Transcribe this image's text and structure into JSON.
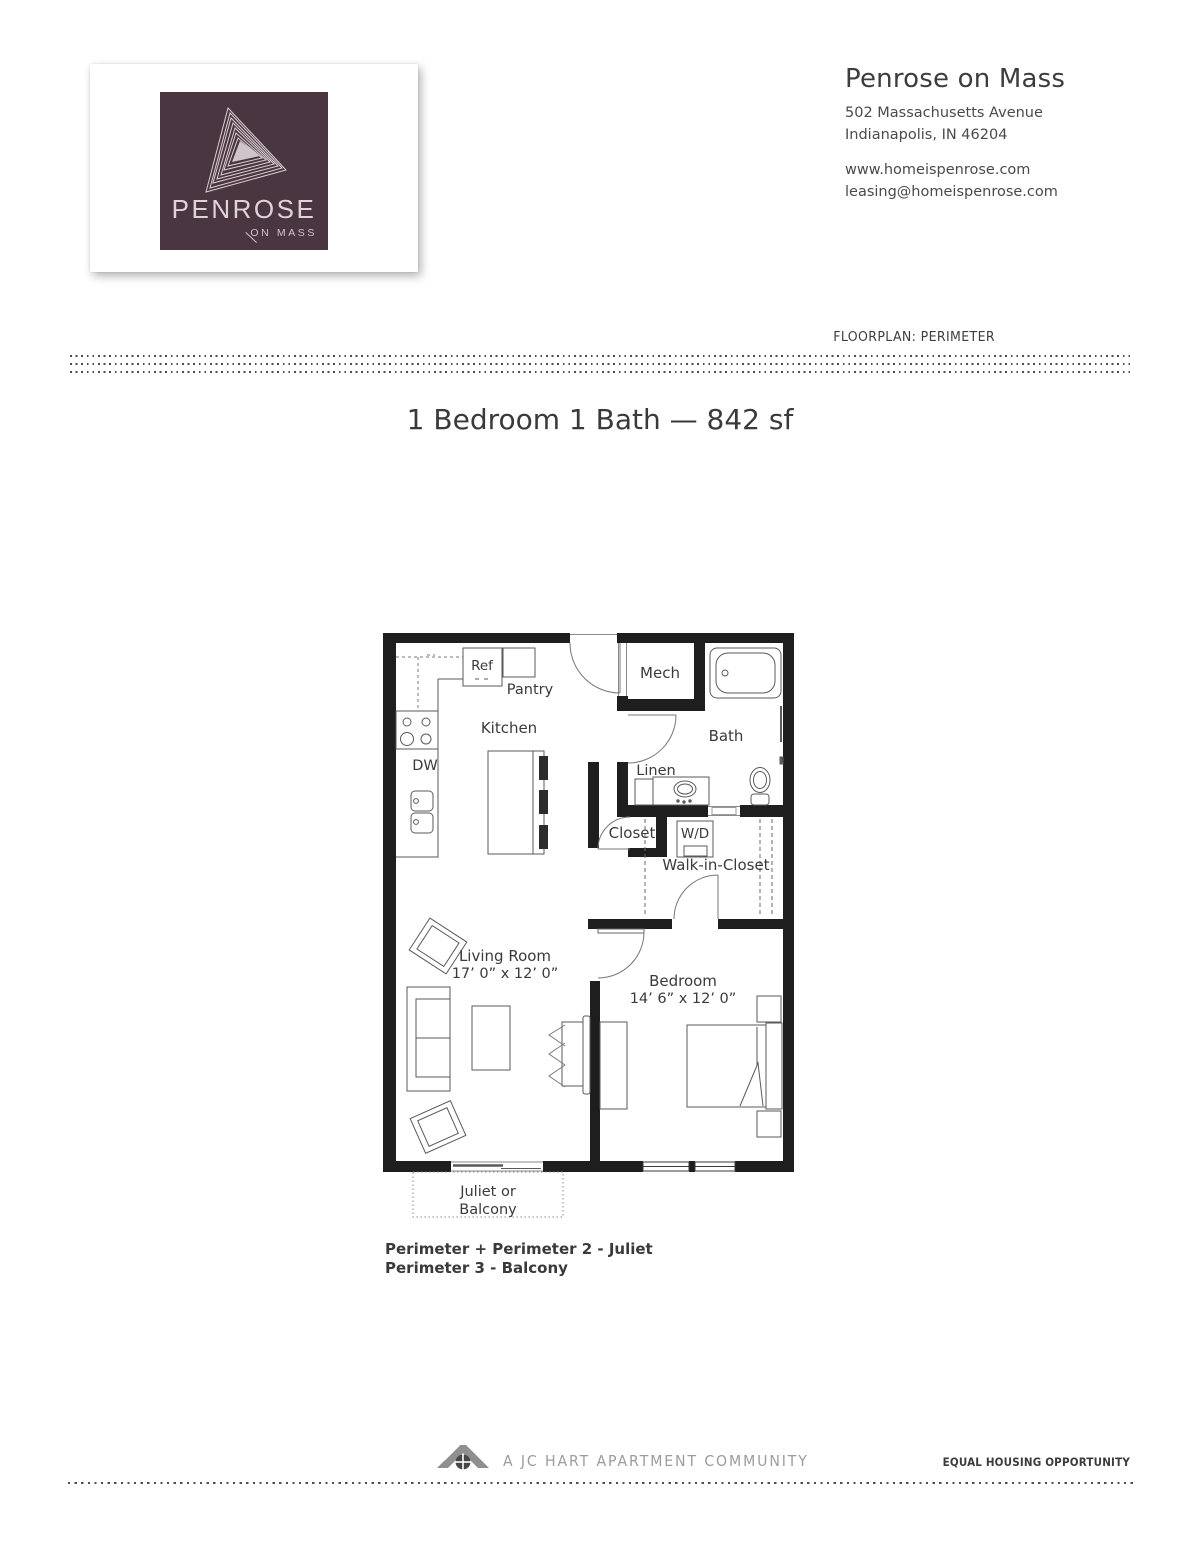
{
  "colors": {
    "logo_bg": "#4a3640",
    "logo_line": "#d8cfd3",
    "wall": "#1e1e1e",
    "label": "#3a3a3a",
    "fixture": "#5a5a5a",
    "muted_gray": "#9c9c9c"
  },
  "logo": {
    "brand": "PENROSE",
    "sub": "ON MASS"
  },
  "header": {
    "property_name": "Penrose on Mass",
    "address_line1": "502 Massachusetts Avenue",
    "address_line2": "Indianapolis, IN 46204",
    "website": "www.homeispenrose.com",
    "email": "leasing@homeispenrose.com",
    "floorplan_label": "FLOORPLAN: PERIMETER"
  },
  "summary": {
    "heading": "1 Bedroom 1 Bath — 842 sf"
  },
  "plan": {
    "rooms": {
      "ref": "Ref",
      "pantry": "Pantry",
      "mech": "Mech",
      "kitchen": "Kitchen",
      "bath": "Bath",
      "dw": "DW",
      "linen": "Linen",
      "closet": "Closet",
      "wd": "W/D",
      "walk_in_closet": "Walk-in-Closet",
      "living_room": "Living Room",
      "living_room_dims": "17’ 0” x 12’ 0”",
      "bedroom": "Bedroom",
      "bedroom_dims": "14’ 6” x 12’ 0”",
      "balcony_line1": "Juliet or",
      "balcony_line2": "Balcony"
    }
  },
  "notes": {
    "line1": "Perimeter + Perimeter 2 - Juliet",
    "line2": "Perimeter 3 - Balcony"
  },
  "footer": {
    "community": "A JC HART APARTMENT COMMUNITY",
    "equal_housing": "EQUAL HOUSING OPPORTUNITY"
  }
}
